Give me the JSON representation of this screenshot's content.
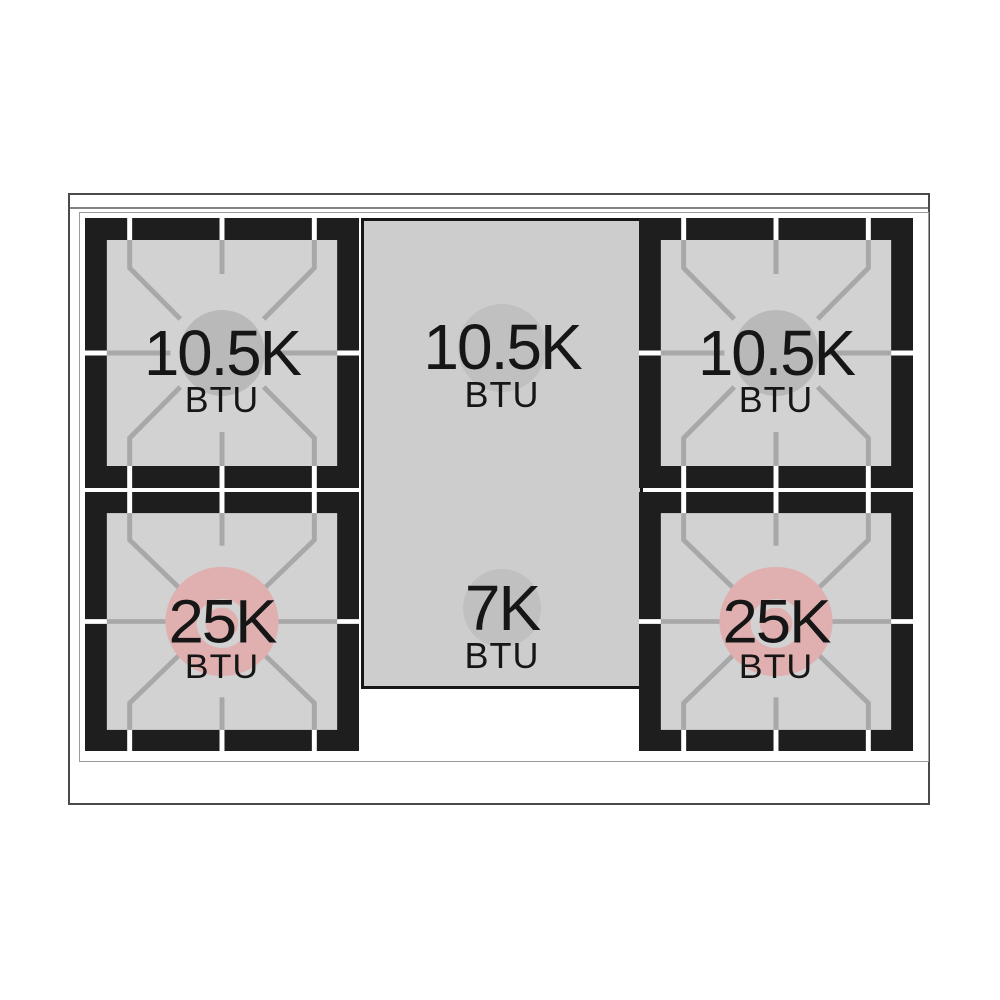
{
  "range_diagram": {
    "type": "gas-cooktop-top-view",
    "burners": {
      "top_left": {
        "value": "10.5K",
        "unit": "BTU"
      },
      "bottom_left": {
        "value": "25K",
        "unit": "BTU"
      },
      "center_top": {
        "value": "10.5K",
        "unit": "BTU"
      },
      "center_bottom": {
        "value": "7K",
        "unit": "BTU"
      },
      "top_right": {
        "value": "10.5K",
        "unit": "BTU"
      },
      "bottom_right": {
        "value": "25K",
        "unit": "BTU"
      }
    },
    "colors": {
      "grate_frame": "#1e1e1e",
      "burner_bed": "#d2d2d2",
      "griddle_bed": "#cdcdcd",
      "grate_bar": "#a8a8a8",
      "small_burner_circle": "#b9b9b9",
      "center_burner_circle": "#c0c0c0",
      "power_burner_circle": "#e0b0b0",
      "power_burner_ring": "#d2d2d2",
      "label_text": "#161616"
    }
  }
}
